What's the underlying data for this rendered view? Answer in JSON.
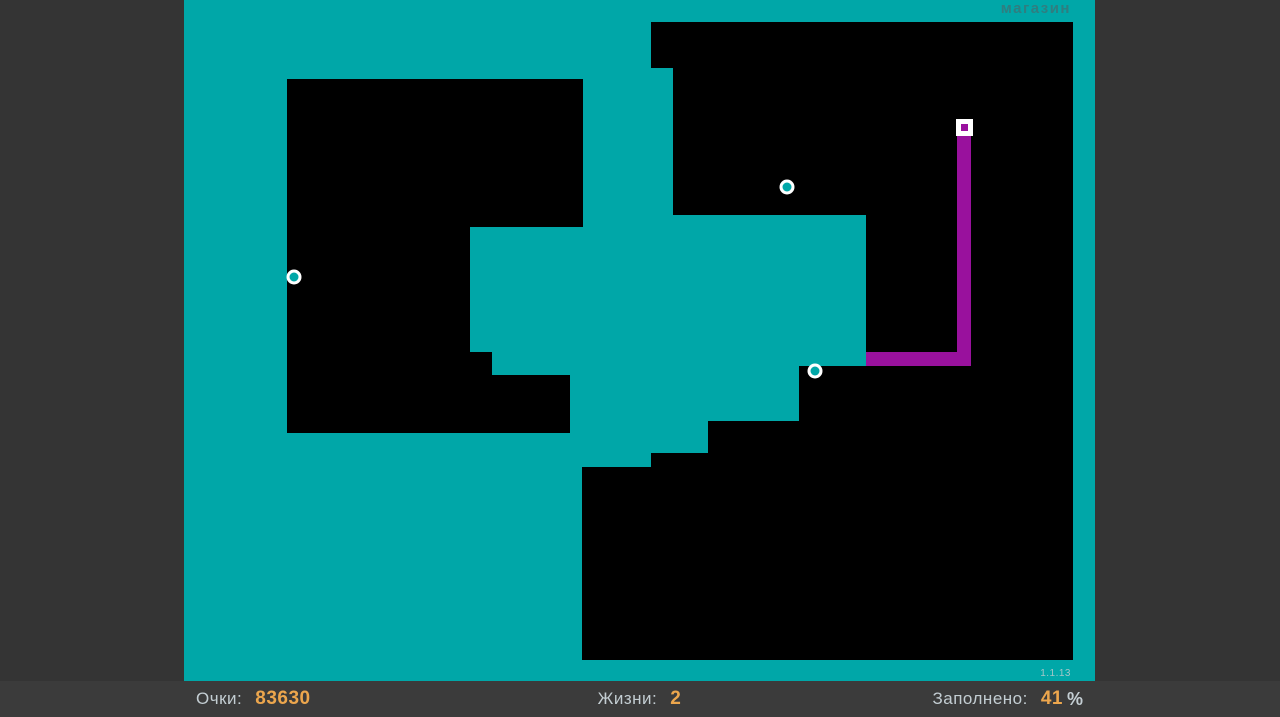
{
  "colors": {
    "page_bg": "#343434",
    "hud_bg": "#3B3B3B",
    "field_teal": "#00A7A8",
    "region_black": "#000000",
    "trail_purple": "#99119D",
    "player_white": "#FFFFFF",
    "enemy_ring_white": "#FFFFFF",
    "label_text": "#C3CDD2",
    "value_text": "#ECA64D",
    "shop_text": "#2F7E80",
    "version_text": "#A3C6C8"
  },
  "header": {
    "shop_label": "магазин"
  },
  "version": "1.1.13",
  "hud": {
    "score": {
      "label": "Очки:",
      "value": "83630"
    },
    "lives": {
      "label": "Жизни:",
      "value": "2"
    },
    "filled": {
      "label": "Заполнено:",
      "value": "41",
      "unit": "%"
    }
  },
  "scene": {
    "field": {
      "x": 184,
      "y": 0,
      "width": 911,
      "height": 681
    },
    "black_regions": [
      [
        [
          103,
          79
        ],
        [
          399,
          79
        ],
        [
          399,
          227
        ],
        [
          286,
          227
        ],
        [
          286,
          352
        ],
        [
          308,
          352
        ],
        [
          308,
          375
        ],
        [
          386,
          375
        ],
        [
          386,
          433
        ],
        [
          103,
          433
        ]
      ],
      [
        [
          467,
          22
        ],
        [
          889,
          22
        ],
        [
          889,
          660
        ],
        [
          398,
          660
        ],
        [
          398,
          467
        ],
        [
          467,
          467
        ],
        [
          467,
          453
        ],
        [
          524,
          453
        ],
        [
          524,
          421
        ],
        [
          615,
          421
        ],
        [
          615,
          366
        ],
        [
          682,
          366
        ],
        [
          682,
          215
        ],
        [
          489,
          215
        ],
        [
          489,
          68
        ],
        [
          467,
          68
        ]
      ]
    ],
    "trail_segments": [
      {
        "x": 773,
        "y": 134,
        "width": 14,
        "height": 232
      },
      {
        "x": 682,
        "y": 352,
        "width": 105,
        "height": 14
      }
    ],
    "player": {
      "x": 772,
      "y": 119,
      "size": 17,
      "inner_size": 7
    },
    "enemies": [
      {
        "cx": 110,
        "cy": 277
      },
      {
        "cx": 603,
        "cy": 187
      },
      {
        "cx": 631,
        "cy": 371
      }
    ],
    "enemy_outer_radius": 7.5,
    "enemy_inner_radius": 4.5
  }
}
